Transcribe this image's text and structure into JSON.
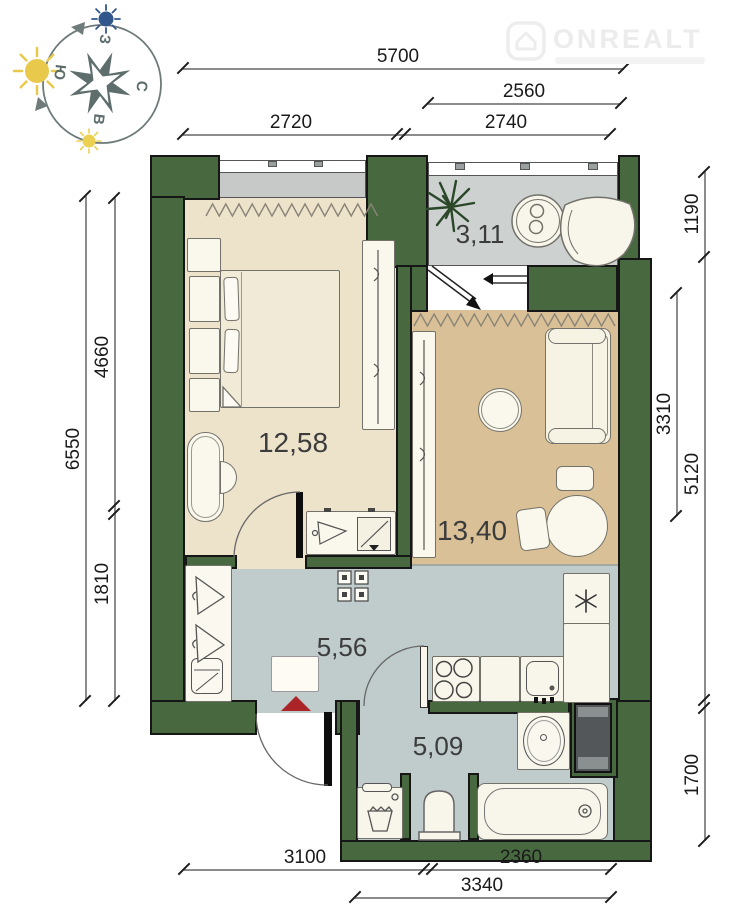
{
  "watermark": {
    "brand": "ONREALT"
  },
  "compass": {
    "west": "З",
    "south": "Ю",
    "north": "С",
    "east": "В"
  },
  "rooms": {
    "balcony": "3,11",
    "bedroom": "12,58",
    "living": "13,40",
    "hallway": "5,56",
    "bathroom": "5,09"
  },
  "dimensions": {
    "top": [
      "5700",
      "2560",
      "2720",
      "2740"
    ],
    "left": [
      "6550",
      "4660",
      "1810"
    ],
    "right": [
      "1190",
      "3310",
      "5120",
      "1700"
    ],
    "bottom": [
      "3100",
      "2360",
      "3340"
    ]
  },
  "colors": {
    "wall": "#486840",
    "bedroom_floor": "#ece3ca",
    "living_floor": "#d9c096",
    "wet_floor": "#c0cbcb",
    "balcony_floor": "#cdd1d0",
    "entrance_arrow": "#ab2428"
  }
}
